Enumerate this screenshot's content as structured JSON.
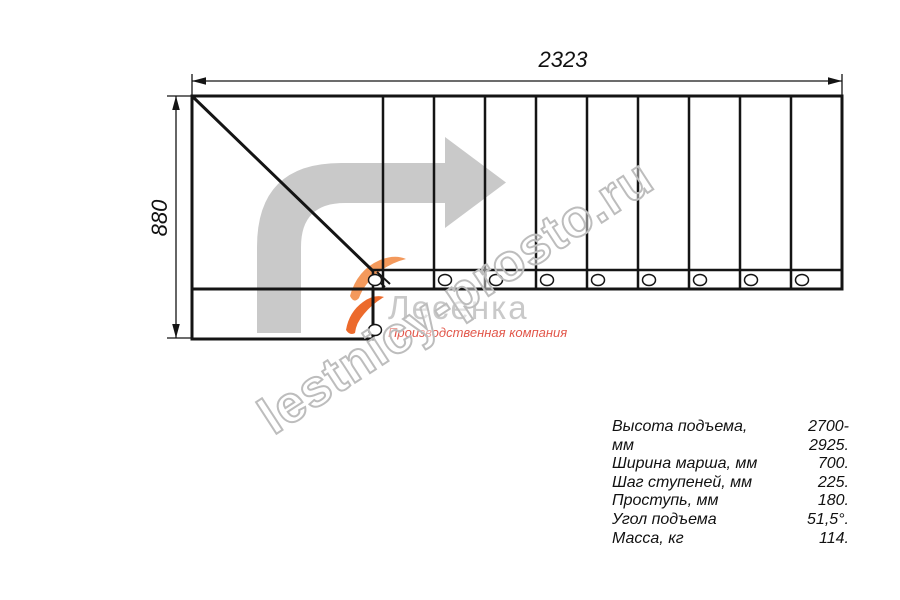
{
  "drawing": {
    "width_dimension": "2323",
    "height_dimension": "880",
    "steps_in_flight": 9,
    "line_color": "#141414",
    "arrow_color": "#c9c9c9"
  },
  "watermark": {
    "text": "lestnicy-prosto.ru",
    "color": "#bdbdbd"
  },
  "logo": {
    "company": "Лесенка",
    "tagline": "Производственная компания",
    "gray": "#c9c9c9",
    "red": "#e2574b",
    "flame_light": "#f3995c",
    "flame_dark": "#ec6a2c"
  },
  "specs": {
    "rows": [
      {
        "label": "Высота подъема, мм",
        "value": "2700-2925."
      },
      {
        "label": "Ширина марша, мм",
        "value": "700."
      },
      {
        "label": "Шаг ступеней, мм",
        "value": "225."
      },
      {
        "label": "Проступь, мм",
        "value": "180."
      },
      {
        "label": "Угол подъема",
        "value": "51,5°."
      },
      {
        "label": "Масса, кг",
        "value": "114."
      }
    ]
  }
}
